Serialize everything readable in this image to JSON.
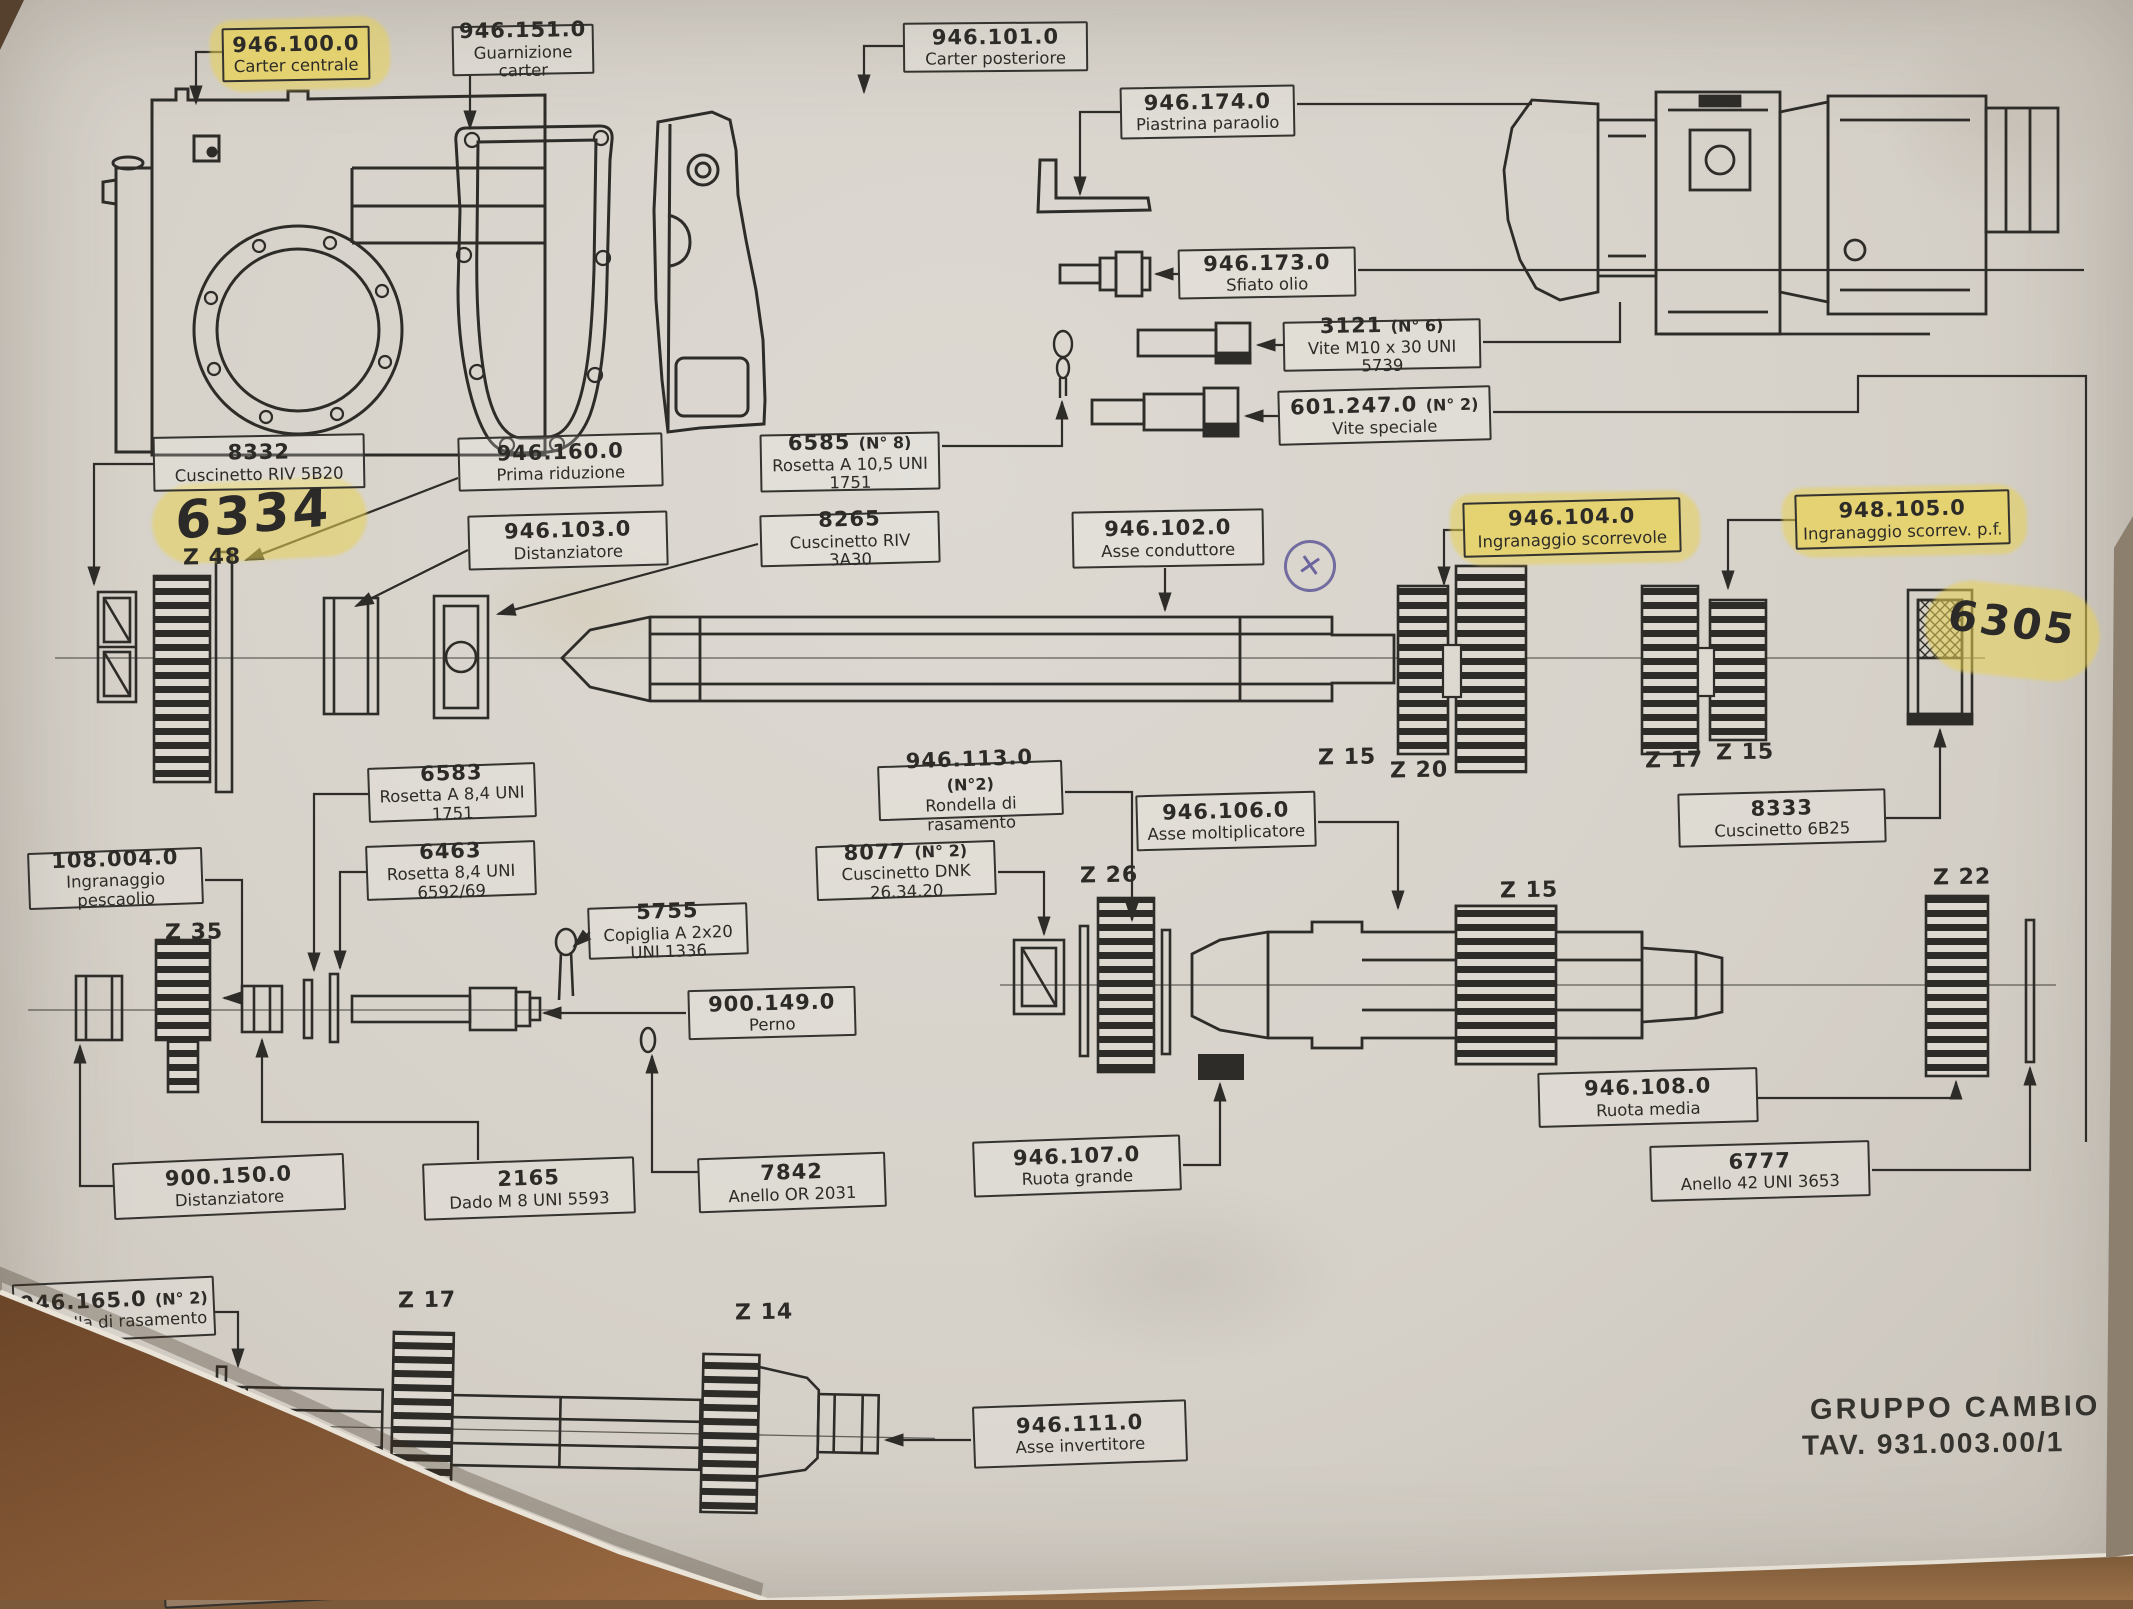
{
  "document": {
    "title_block": {
      "line1": "GRUPPO CAMBIO",
      "line2": "TAV. 931.003.00/1"
    },
    "handwritten": {
      "a": "6334",
      "b": "6305"
    },
    "stamp": {
      "circled_x": "✕"
    },
    "colors": {
      "paper": "#d6d1c9",
      "ink": "#2e2c28",
      "highlight": "#e8d154",
      "table_brown": "#8a5f3a"
    },
    "gears": [
      "Z 48",
      "Z 15",
      "Z 20",
      "Z 17",
      "Z 15",
      "Z 35",
      "Z 26",
      "Z 15",
      "Z 22",
      "Z 17",
      "Z 14"
    ],
    "labels": [
      {
        "code": "946.100.0",
        "note": "",
        "name": "Carter centrale",
        "highlight": true
      },
      {
        "code": "946.151.0",
        "note": "",
        "name": "Guarnizione carter",
        "highlight": false
      },
      {
        "code": "946.101.0",
        "note": "",
        "name": "Carter posteriore",
        "highlight": false
      },
      {
        "code": "946.174.0",
        "note": "",
        "name": "Piastrina paraolio",
        "highlight": false
      },
      {
        "code": "946.173.0",
        "note": "",
        "name": "Sfiato olio",
        "highlight": false
      },
      {
        "code": "3121",
        "note": "(N° 6)",
        "name": "Vite M10 x 30 UNI 5739",
        "highlight": false
      },
      {
        "code": "601.247.0",
        "note": "(N° 2)",
        "name": "Vite speciale",
        "highlight": false
      },
      {
        "code": "8332",
        "note": "",
        "name": "Cuscinetto RIV 5B20",
        "highlight": false
      },
      {
        "code": "946.160.0",
        "note": "",
        "name": "Prima riduzione",
        "highlight": false
      },
      {
        "code": "946.103.0",
        "note": "",
        "name": "Distanziatore",
        "highlight": false
      },
      {
        "code": "6585",
        "note": "(N° 8)",
        "name": "Rosetta A 10,5 UNI 1751",
        "highlight": false
      },
      {
        "code": "8265",
        "note": "",
        "name": "Cuscinetto RIV 3A30",
        "highlight": false
      },
      {
        "code": "946.102.0",
        "note": "",
        "name": "Asse conduttore",
        "highlight": false
      },
      {
        "code": "946.104.0",
        "note": "",
        "name": "Ingranaggio scorrevole",
        "highlight": true
      },
      {
        "code": "948.105.0",
        "note": "",
        "name": "Ingranaggio scorrev. p.f.",
        "highlight": true
      },
      {
        "code": "6583",
        "note": "",
        "name": "Rosetta A 8,4 UNI 1751",
        "highlight": false
      },
      {
        "code": "108.004.0",
        "note": "",
        "name": "Ingranaggio pescaolio",
        "highlight": false
      },
      {
        "code": "6463",
        "note": "",
        "name": "Rosetta 8,4 UNI 6592/69",
        "highlight": false
      },
      {
        "code": "5755",
        "note": "",
        "name": "Copiglia A 2x20 UNI 1336",
        "highlight": false
      },
      {
        "code": "900.149.0",
        "note": "",
        "name": "Perno",
        "highlight": false
      },
      {
        "code": "946.113.0",
        "note": "(N°2)",
        "name": "Rondella di rasamento",
        "highlight": false
      },
      {
        "code": "8077",
        "note": "(N° 2)",
        "name": "Cuscinetto DNK 26.34.20",
        "highlight": false
      },
      {
        "code": "946.106.0",
        "note": "",
        "name": "Asse moltiplicatore",
        "highlight": false
      },
      {
        "code": "8333",
        "note": "",
        "name": "Cuscinetto 6B25",
        "highlight": false
      },
      {
        "code": "946.108.0",
        "note": "",
        "name": "Ruota media",
        "highlight": false
      },
      {
        "code": "6777",
        "note": "",
        "name": "Anello 42 UNI 3653",
        "highlight": false
      },
      {
        "code": "946.107.0",
        "note": "",
        "name": "Ruota grande",
        "highlight": false
      },
      {
        "code": "900.150.0",
        "note": "",
        "name": "Distanziatore",
        "highlight": false
      },
      {
        "code": "2165",
        "note": "",
        "name": "Dado M 8 UNI 5593",
        "highlight": false
      },
      {
        "code": "7842",
        "note": "",
        "name": "Anello OR 2031",
        "highlight": false
      },
      {
        "code": "946.165.0",
        "note": "(N° 2)",
        "name": "Rondella di rasamento",
        "highlight": false
      },
      {
        "code": "946.111.0",
        "note": "",
        "name": "Asse invertitore",
        "highlight": false
      },
      {
        "code": "8088",
        "note": "(N° 2)",
        "name": "RNA 20.28.23",
        "highlight": false
      }
    ]
  }
}
